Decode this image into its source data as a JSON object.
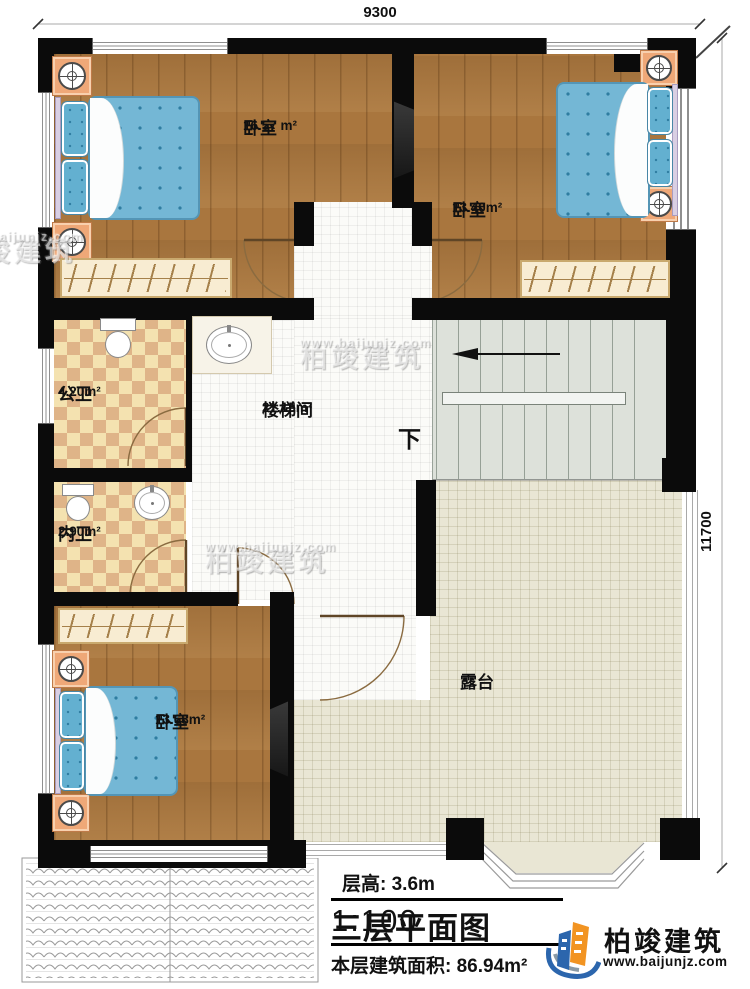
{
  "dimensions": {
    "width": "9300",
    "height": "11700"
  },
  "rooms": [
    {
      "id": "bedroom-top-left",
      "name": "卧室",
      "area": "16.57 m²"
    },
    {
      "id": "bedroom-top-right",
      "name": "卧室",
      "area": "13.40m²"
    },
    {
      "id": "public-bathroom",
      "name": "公卫",
      "area": "4.20m²"
    },
    {
      "id": "stair-hall",
      "name": "楼梯间",
      "area": "21.15m²"
    },
    {
      "id": "inner-bathroom",
      "name": "内卫",
      "area": "2.90m²"
    },
    {
      "id": "bedroom-bottom",
      "name": "卧室",
      "area": "13.68m²"
    },
    {
      "id": "terrace",
      "name": "露台",
      "area": ""
    }
  ],
  "stairs": {
    "down_label": "下"
  },
  "title_block": {
    "floor_height": "层高: 3.6m",
    "title": "三层平面图",
    "scale": "1:100",
    "floor_area": "本层建筑面积: 86.94m²"
  },
  "brand": {
    "name": "柏竣建筑",
    "site": "www.baijunjz.com"
  },
  "colors": {
    "wall": "#0b0b0b",
    "wood_floor": "#a9763e",
    "bath_checker_dark": "#dfb488",
    "bath_checker_light": "#f4e2b0",
    "terrace_floor": "#e9e6d4",
    "stair_floor": "#dde1da",
    "bed_duvet": "#74b7d5",
    "nightstand": "#efa878",
    "logo_blue": "#2c66ad",
    "logo_orange": "#f29422"
  }
}
